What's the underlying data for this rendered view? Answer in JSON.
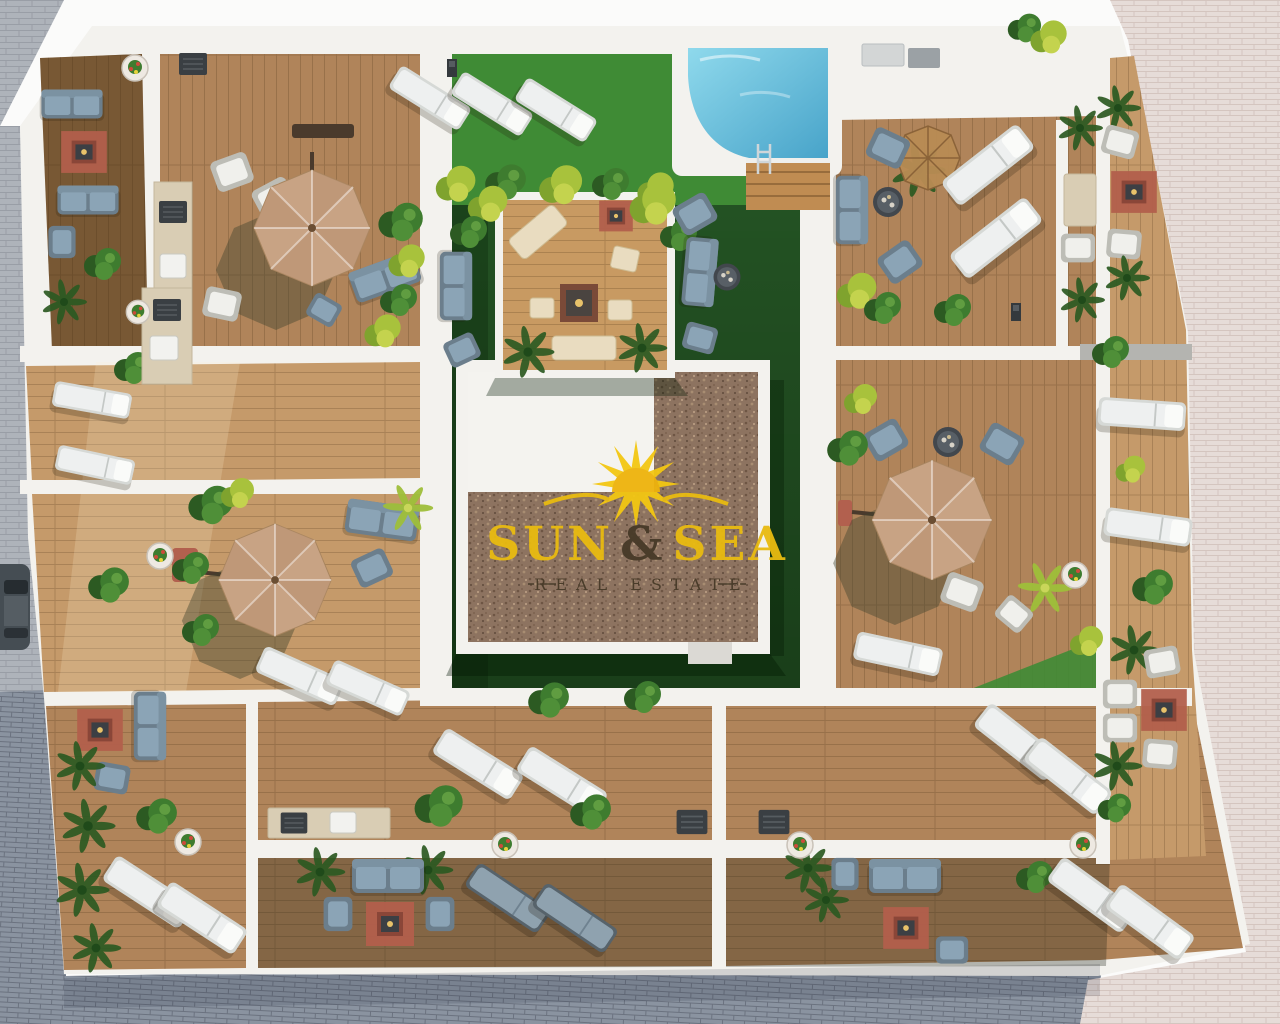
{
  "watermark": {
    "word1": "SUN",
    "amp": "&",
    "word2": "SEA",
    "tagline": "REAL ESTATE"
  },
  "scene": {
    "description": "Aerial 3D architectural render of rooftop apartment terraces around a central landscaped courtyard with swimming pool",
    "objects": [
      "swimming-pool",
      "garden-courtyard",
      "central-roof",
      "pergola-deck",
      "parasols",
      "sun-loungers",
      "garden-sofas",
      "outdoor-rugs",
      "outdoor-kitchens",
      "potted-plants",
      "palm-plants",
      "parked-car",
      "street-paving"
    ]
  },
  "palette": {
    "paving_gray": "#aeb3ba",
    "paving_dark": "#8a93a0",
    "paving_pink": "#e6dcd8",
    "wall_white": "#f3f2ee",
    "wood_light": "#c59a6a",
    "wood_mid": "#b0845a",
    "wood_dark": "#8f683f",
    "wood_deck": "#c89a62",
    "grass_bright": "#3f8b35",
    "grass_dark": "#235223",
    "pool_light": "#8fd9ec",
    "pool_deep": "#47a3c9",
    "gravel": "#8d7360",
    "umbrella": "#c8a384",
    "umbrella_dark": "#b8906f",
    "lounger": "#eef0f0",
    "lounger_gray": "#8fa2af",
    "sofa": "#8ba4b6",
    "rug": "#b25f4c",
    "cream": "#e9dcc0",
    "plant": "#3e7c2f",
    "plant_dark": "#2c5a22",
    "plant_yellow": "#a8c23c",
    "sun_yellow": "#f3c713",
    "logo_text": "#e9bb10",
    "logo_dark": "#473a28"
  }
}
